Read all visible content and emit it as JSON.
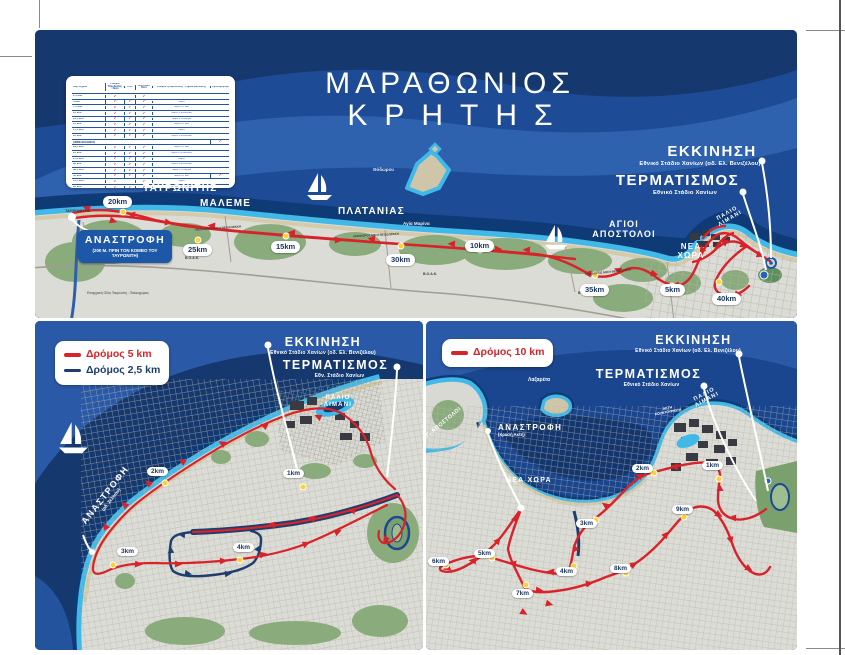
{
  "poster": {
    "title_line1": "ΜΑΡΑΘΩΝΙΟΣ",
    "title_line2": "ΚΡΗΤΗΣ"
  },
  "colors": {
    "route_red": "#d8232a",
    "route_blue": "#1d3e6f",
    "sea_dark": "#15386f",
    "sea_mid": "#1e4b95",
    "sea_light": "#2e61ae",
    "coast_cyan": "#41b9e8",
    "land_gray": "#dcdcd6",
    "green": "#8aab7c",
    "beach": "#d5cbaa",
    "badge_navy": "#1c57a8",
    "km_dot_yellow": "#ffd12f"
  },
  "stations_table": {
    "header": [
      "Χλμ. Σημεία",
      "Σταθμοί Υδροδοσίας - Νερό",
      "Γκελ",
      "Ισοτονικό Ποτό",
      "Σταθμοί Τροφοδοσίας - Σημεία Διέλευσης",
      "Χρονομέτρηση"
    ],
    "rows": [
      {
        "km": "2,5 klm",
        "c": [
          1,
          0,
          1
        ],
        "note": "",
        "t": 0
      },
      {
        "km": "5 klm",
        "c": [
          1,
          1,
          1
        ],
        "note": "Νερό",
        "t": 0
      },
      {
        "km": "7,5 klm",
        "c": [
          1,
          1,
          1
        ],
        "note": "Νερό + Γκελ",
        "t": 0
      },
      {
        "km": "10 klm",
        "c": [
          1,
          1,
          1
        ],
        "note": "Νερό + Ισοτονικό",
        "t": 0
      },
      {
        "km": "12,5 klm",
        "c": [
          1,
          1,
          1
        ],
        "note": "Νερό + Σπόγγοι",
        "t": 0
      },
      {
        "km": "15 klm",
        "c": [
          1,
          1,
          1
        ],
        "note": "Νερό + Γκελ",
        "t": 0
      },
      {
        "km": "17,5 klm",
        "c": [
          1,
          1,
          1
        ],
        "note": "Νερό",
        "t": 0
      },
      {
        "km": "20 klm",
        "c": [
          1,
          1,
          1
        ],
        "note": "Νερό + Ισοτονικό",
        "t": 0
      },
      {
        "km": "21,1 klm (ΗΜΙΜΑΡΑΘΩΝΙΟΣ)",
        "c": [
          0,
          0,
          0
        ],
        "note": "",
        "t": 1,
        "hl": "row"
      },
      {
        "km": "22,5 klm",
        "c": [
          1,
          1,
          1
        ],
        "note": "Νερό + Γκελ",
        "t": 0
      },
      {
        "km": "25 klm",
        "c": [
          1,
          1,
          1
        ],
        "note": "Νερό + Μπανάνα",
        "t": 0
      },
      {
        "km": "27,5 klm",
        "c": [
          1,
          1,
          1
        ],
        "note": "Νερό",
        "t": 0
      },
      {
        "km": "30 klm",
        "c": [
          1,
          1,
          1
        ],
        "note": "Νερό + Ισοτονικό",
        "t": 0
      },
      {
        "km": "32,5 klm",
        "c": [
          1,
          1,
          1
        ],
        "note": "Νερό + Σπόγγοι",
        "t": 0
      },
      {
        "km": "35 klm",
        "c": [
          1,
          1,
          1
        ],
        "note": "Νερό + Γκελ",
        "t": 1
      },
      {
        "km": "37,5 klm",
        "c": [
          1,
          0,
          1
        ],
        "note": "Νερό",
        "t": 0
      },
      {
        "km": "40 klm",
        "c": [
          1,
          1,
          1
        ],
        "note": "Νερό + Ισοτονικό",
        "t": 0
      },
      {
        "km": "42,195 klm - ΤΕΡΜΑΤΙΣΜΟΣ",
        "c": [
          1,
          1,
          1
        ],
        "note": "Νερό + Ισοτονικό",
        "t": 1,
        "hl": "end"
      }
    ]
  },
  "main_map": {
    "start_label": "ΕΚΚΙΝΗΣΗ",
    "start_sub": "Εθνικό Στάδιο Χανίων (οδ. Ελ. Βενιζέλου)",
    "finish_label": "ΤΕΡΜΑΤΙΣΜΟΣ",
    "finish_sub": "Εθνικό Στάδιο Χανίων",
    "turn_label": "ΑΝΑΣΤΡΟΦΗ",
    "turn_sub": "(200 Μ. ΠΡΙΝ ΤΟΝ ΚΟΜΒΟ ΤΟΥ ΤΑΥΡΩΝΙΤΗ)",
    "sea_labels": {
      "tavronitis": "ΤΑΥΡΩΝΙΤΗΣ",
      "maleme": "ΜΑΛΕΜΕ",
      "platanias": "ΠΛΑΤΑΝΙΑΣ",
      "agia_marina": "Αγία Μαρίνα",
      "agioi_apostoloi_1": "ΑΓΙΟΙ",
      "agioi_apostoloi_2": "ΑΠΟΣΤΟΛΟΙ",
      "nea_chora": "ΝΕΑ ΧΩΡΑ",
      "palio_limani": "ΠΑΛΙΟ ΛΙΜΑΝΙ",
      "thodorou": "Θόδωρου"
    },
    "map_labels": {
      "tavronitis_village": "ΤΑΥΡΩΝΙΤΗΣ",
      "boak": "Β.Ο.Α.Κ.",
      "leoforos": "ΛΕΩΦΟΡΟΣ ΜΙΚΗ ΘΕΟΔΩΡΑΚΗ",
      "eparxiaki": "Επαρχιακή Οδός Ταυρωνίτη - Παλαιοχώρας"
    },
    "km_markers": [
      "20km",
      "25km",
      "15km",
      "30km",
      "10km",
      "35km",
      "5km",
      "40km"
    ]
  },
  "map_5k": {
    "legend": [
      {
        "label": "Δρόμος 5 km",
        "color": "#d8232a"
      },
      {
        "label": "Δρόμος 2,5 km",
        "color": "#1d3e6f"
      }
    ],
    "start_label": "ΕΚΚΙΝΗΣΗ",
    "start_sub": "Εθνικό Στάδιο Χανίων (οδ. Ελ. Βενιζέλου)",
    "finish_label": "ΤΕΡΜΑΤΙΣΜΟΣ",
    "finish_sub": "Εθν. Στάδιο Χανίων",
    "turn_label": "ΑΝΑΣΤΡΟΦΗ",
    "turn_sub": "(οδ. Σελίνου)",
    "palio_limani": "ΠΑΛΙΟ ΛΙΜΑΝΙ",
    "km_markers": [
      "1km",
      "2km",
      "3km",
      "4km"
    ]
  },
  "map_10k": {
    "legend": [
      {
        "label": "Δρόμος 10 km",
        "color": "#d8232a"
      }
    ],
    "start_label": "ΕΚΚΙΝΗΣΗ",
    "start_sub": "Εθνικό Στάδιο Χανίων (οδ. Ελ. Βενιζέλου)",
    "finish_label": "ΤΕΡΜΑΤΙΣΜΟΣ",
    "finish_sub": "Εθνικό Στάδιο Χανίων",
    "turn_label": "ΑΝΑΣΤΡΟΦΗ",
    "turn_sub": "(Χρυσή Ακτή)",
    "labels": {
      "lazareta": "Λαζαρέτα",
      "ag_apostoloi": "ΑΓ. ΑΠΟΣΤΟΛΟΙ",
      "nea_chora": "ΝΕΑ ΧΩΡΑ",
      "palio_limani": "ΠΑΛΙΟ ΛΙΜΑΝΙ",
      "akti": "ΑΚΤΗ ΚΟΥΝΤΟΥΡΙΩΤΗ"
    },
    "km_markers": [
      "1km",
      "2km",
      "3km",
      "4km",
      "5km",
      "6km",
      "7km",
      "8km",
      "9km"
    ]
  }
}
